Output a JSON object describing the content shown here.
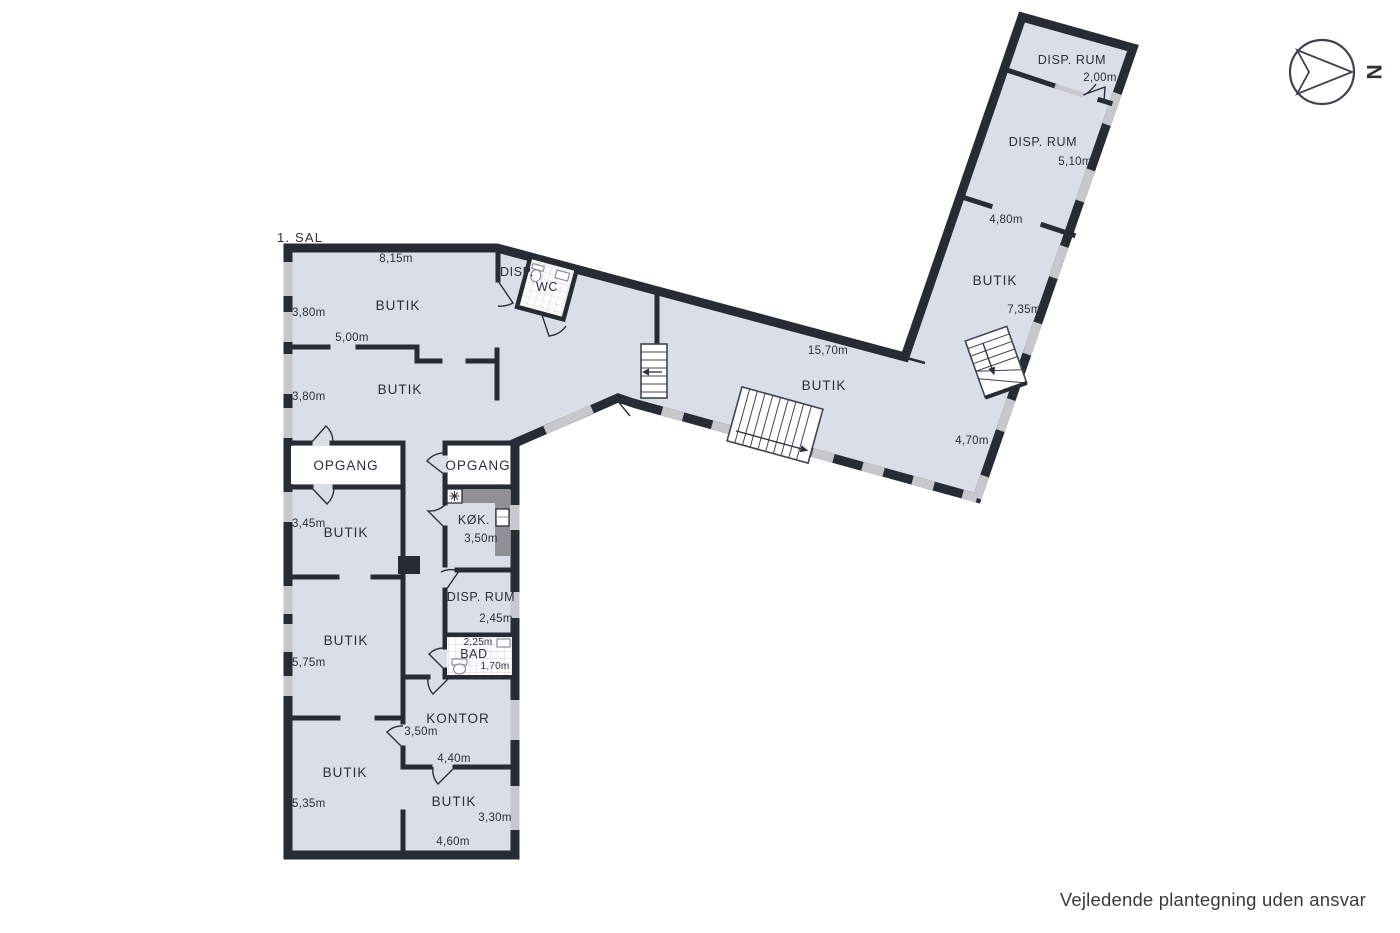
{
  "title": "1. SAL",
  "footer": "Vejledende plantegning uden ansvar",
  "compass": {
    "north": "N"
  },
  "colors": {
    "room_fill": "#d9dee9",
    "wall": "#272b33",
    "window": "#c6c8cb",
    "counter": "#8e9195",
    "text": "#2b2f38"
  },
  "rooms": {
    "butik_top": {
      "label": "BUTIK",
      "width": "8,15m",
      "depth": "3,80m"
    },
    "disp_top": {
      "label": "DISP."
    },
    "wc": {
      "label": "WC"
    },
    "butik_mid": {
      "label": "BUTIK",
      "width": "5,00m",
      "depth": "3,80m"
    },
    "opgang_left": {
      "label": "OPGANG"
    },
    "opgang_right": {
      "label": "OPGANG"
    },
    "kok": {
      "label": "KØK.",
      "width": "3,50m"
    },
    "butik_345": {
      "label": "BUTIK",
      "depth": "3,45m"
    },
    "disp_rum": {
      "label": "DISP. RUM",
      "depth": "2,45m"
    },
    "bad": {
      "label": "BAD",
      "width": "2,25m",
      "depth": "1,70m"
    },
    "butik_575": {
      "label": "BUTIK",
      "depth": "5,75m"
    },
    "kontor": {
      "label": "KONTOR",
      "depth": "3,50m",
      "width": "4,40m"
    },
    "butik_535": {
      "label": "BUTIK",
      "depth": "5,35m"
    },
    "butik_br": {
      "label": "BUTIK",
      "depth": "3,30m",
      "width": "4,60m"
    },
    "butik_corridor": {
      "label": "BUTIK",
      "width": "15,70m"
    },
    "wing_disp_top": {
      "label": "DISP. RUM",
      "depth": "2,00m"
    },
    "wing_disp": {
      "label": "DISP. RUM",
      "depth": "5,10m"
    },
    "wing_butik": {
      "label": "BUTIK",
      "width": "4,80m",
      "depth": "7,35m",
      "bottom_width": "4,70m"
    }
  }
}
